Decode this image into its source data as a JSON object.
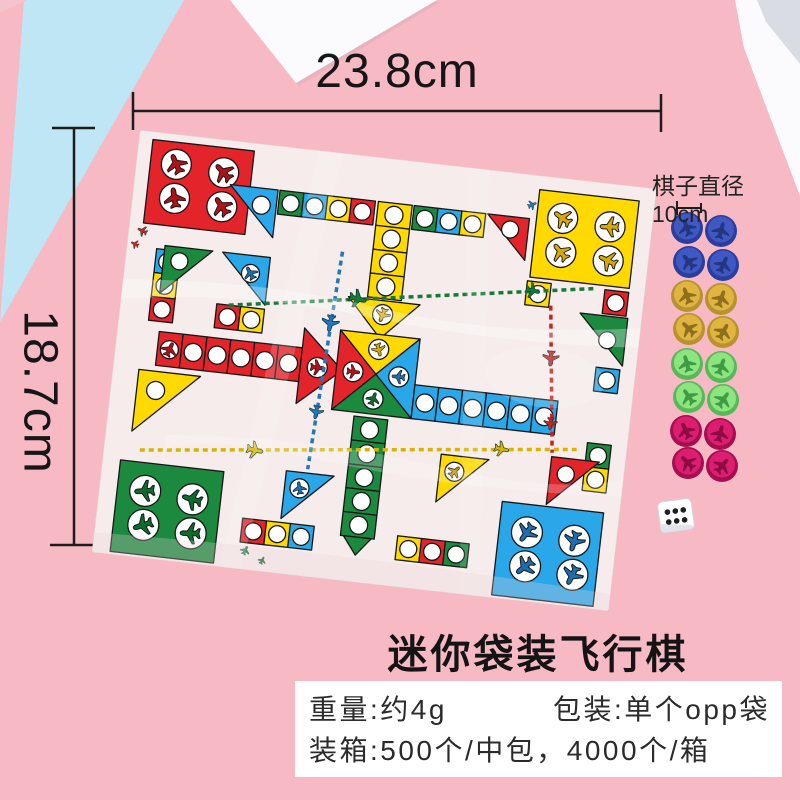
{
  "annotations": {
    "width_label": "23.8cm",
    "height_label": "18.7cm",
    "piece_diameter_label": "棋子直径10cm"
  },
  "product": {
    "title": "迷你袋装飞行棋"
  },
  "specs": {
    "weight": "重量:约4g",
    "package": "包装:单个opp袋",
    "carton": "装箱:500个/中包，4000个/箱"
  },
  "background": {
    "backdrop_pink": "#f7b9c4",
    "backdrop_blue": "#bee6f5",
    "paper_white": "#fbfbfe"
  },
  "board": {
    "bag_color": "#f5eceb",
    "colors": {
      "red": "#e3242b",
      "green": "#1b8a3f",
      "blue": "#2aa7e8",
      "yellow": "#ffd900"
    }
  },
  "pieces": {
    "per_group": 4,
    "groups": [
      {
        "color_name": "blue",
        "hex": "#3f58c4"
      },
      {
        "color_name": "yellow",
        "hex": "#e0b440"
      },
      {
        "color_name": "green",
        "hex": "#8ce57f"
      },
      {
        "color_name": "pink",
        "hex": "#dd1d6f"
      }
    ],
    "dice": {
      "face_value": 6,
      "color": "#ffffff"
    }
  }
}
